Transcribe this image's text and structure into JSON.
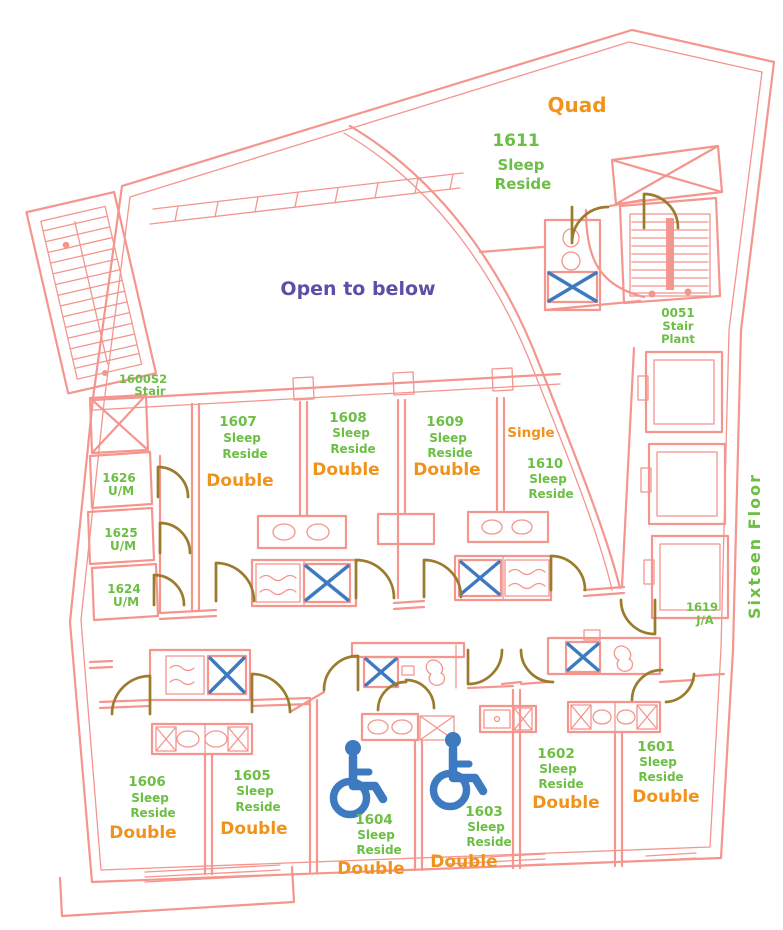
{
  "palette": {
    "wall_pink": "#f4958e",
    "label_green": "#6cbe45",
    "label_orange": "#f0931d",
    "label_purple": "#5b50a5",
    "fixture_blue": "#3d7abf",
    "door_brown": "#9b7b2d"
  },
  "annotations": {
    "open_to_below": "Open to below",
    "floor_name": "Sixteen Floor"
  },
  "stairs": {
    "left": {
      "number": "1600S2",
      "label": "Stair"
    },
    "right": {
      "number": "0051",
      "l1": "Stair",
      "l2": "Plant"
    }
  },
  "janitor": {
    "number": "1619",
    "label": "J/A"
  },
  "utility_rooms": [
    {
      "number": "1626",
      "type": "U/M"
    },
    {
      "number": "1625",
      "type": "U/M"
    },
    {
      "number": "1624",
      "type": "U/M"
    }
  ],
  "rooms": {
    "r1611": {
      "number": "1611",
      "l1": "Sleep",
      "l2": "Reside",
      "occupancy": "Quad"
    },
    "r1607": {
      "number": "1607",
      "l1": "Sleep",
      "l2": "Reside",
      "type": "Double"
    },
    "r1608": {
      "number": "1608",
      "l1": "Sleep",
      "l2": "Reside",
      "type": "Double"
    },
    "r1609": {
      "number": "1609",
      "l1": "Sleep",
      "l2": "Reside",
      "type": "Double"
    },
    "r1610": {
      "number": "1610",
      "l1": "Sleep",
      "l2": "Reside",
      "occupancy": "Single"
    },
    "r1606": {
      "number": "1606",
      "l1": "Sleep",
      "l2": "Reside",
      "type": "Double"
    },
    "r1605": {
      "number": "1605",
      "l1": "Sleep",
      "l2": "Reside",
      "type": "Double"
    },
    "r1604": {
      "number": "1604",
      "l1": "Sleep",
      "l2": "Reside",
      "type": "Double"
    },
    "r1603": {
      "number": "1603",
      "l1": "Sleep",
      "l2": "Reside",
      "type": "Double"
    },
    "r1602": {
      "number": "1602",
      "l1": "Sleep",
      "l2": "Reside",
      "type": "Double"
    },
    "r1601": {
      "number": "1601",
      "l1": "Sleep",
      "l2": "Reside",
      "type": "Double"
    }
  }
}
